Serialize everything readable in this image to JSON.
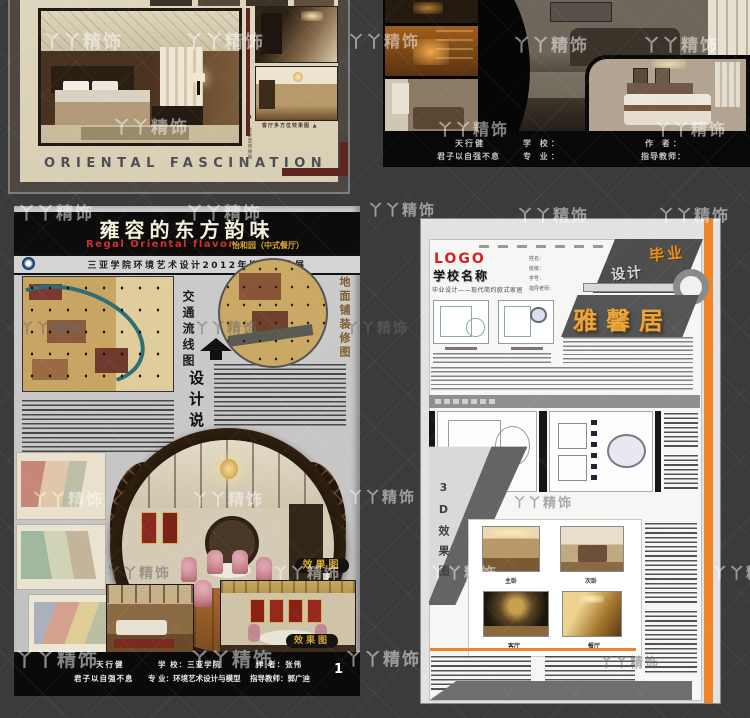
{
  "watermark": {
    "text": "丫丫精饰"
  },
  "background": {
    "color": "#3b3b3b"
  },
  "poster_oriental": {
    "title": "ORIENTAL FASCINATION",
    "caption_photos": "客厅多方位效果图 ▲",
    "caption_side": "◀ 主卧室效果图",
    "accent_color": "#5e2420"
  },
  "poster_european": {
    "motto_line1": "天行健",
    "motto_line2": "君子以自强不息",
    "school_label": "学 校：",
    "major_label": "专 业：",
    "author_label": "作 者：",
    "advisor_label": "指导教师："
  },
  "poster_regal": {
    "title": "雍容的东方韵味",
    "subtitle_en": "Regal Oriental flavor",
    "subtitle_cn": "怡和园（中式餐厅）",
    "banner": "三亚学院环境艺术设计2012年毕业设计展",
    "label_traffic": "交通流线图",
    "label_paving": "地面铺装修图",
    "label_design_notes": "设计说明",
    "label_render": "效果图",
    "footer": {
      "motto_line1": "天行健",
      "motto_line2": "君子以自强不息",
      "school": "学 校：三亚学院",
      "major": "专 业：环境艺术设计与模型",
      "author": "作 者：张伟",
      "advisor": "指导教师：郭广迪",
      "page_number": "1"
    }
  },
  "poster_modern": {
    "logo": "LOGO",
    "school_name": "学校名称",
    "tagline": "毕业设计——现代简约欧式家居",
    "fields": [
      "姓名：",
      "班级：",
      "学号：",
      "指导老师："
    ],
    "badge_word1": "毕业",
    "badge_word2": "设计",
    "title": "雅馨居",
    "label_3d": "3D效果图",
    "render_labels": [
      "主卧",
      "次卧",
      "客厅",
      "餐厅"
    ],
    "accent_color": "#f08228"
  }
}
